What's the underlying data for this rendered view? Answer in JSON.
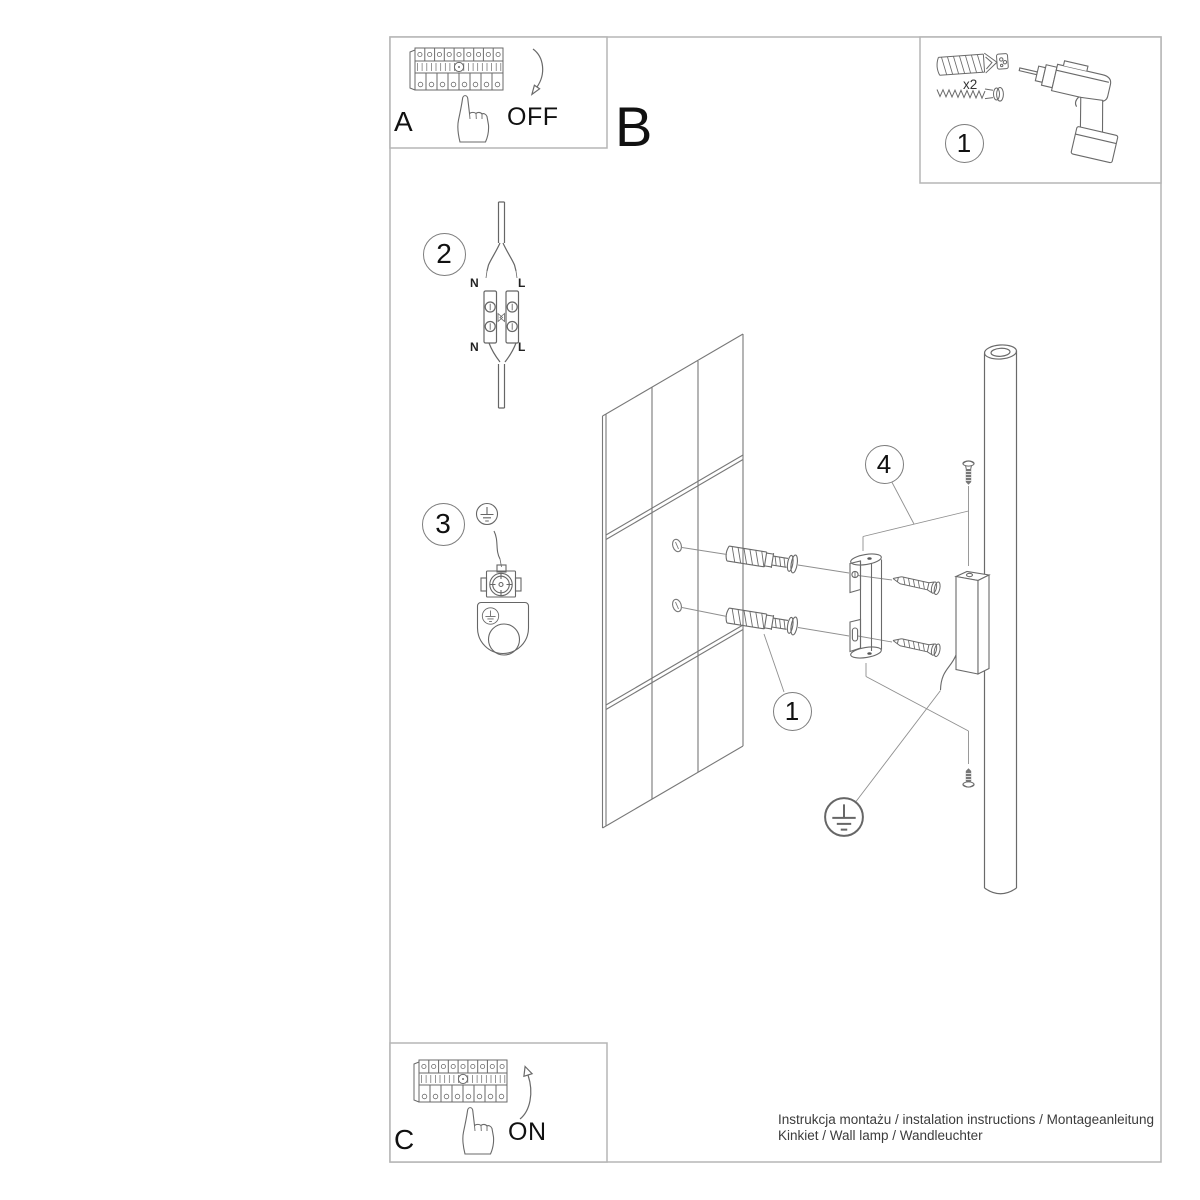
{
  "footer": {
    "line1": "Instrukcja montażu / instalation instructions / Montageanleitung",
    "line2": "Kinkiet / Wall lamp / Wandleuchter"
  },
  "labels": {
    "panel_a": "A",
    "panel_b": "B",
    "panel_c": "C",
    "power_off": "OFF",
    "power_on": "ON",
    "kit_quantity": "x2"
  },
  "badges": {
    "kit": "1",
    "wiring": "2",
    "earth": "3",
    "anchors": "1",
    "fixing_screw": "4"
  },
  "terminal": {
    "top_left": "N",
    "top_right": "L",
    "bottom_left": "N",
    "bottom_right": "L"
  },
  "colors": {
    "line_art": "#666666",
    "frame_border": "#b5b5b5",
    "leader_line": "#8f8f8f",
    "text": "#111111"
  }
}
